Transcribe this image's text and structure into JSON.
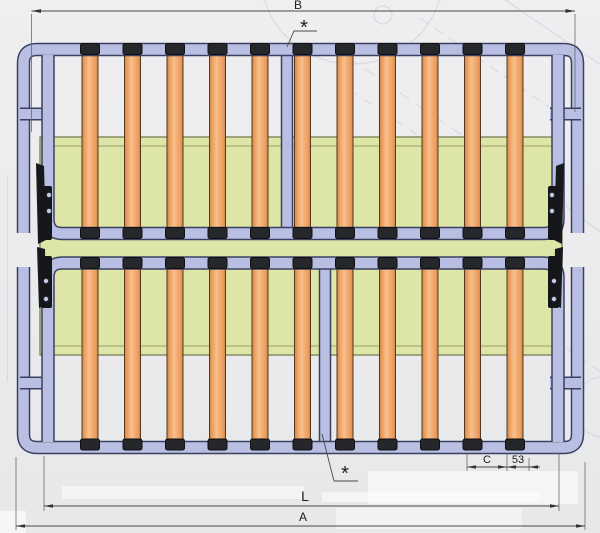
{
  "meta": {
    "subject": "folding slatted bed-base frame, plan view technical drawing"
  },
  "labels": {
    "dim_b": "B",
    "asterisk_top": "*",
    "asterisk_bottom": "*",
    "dim_c": "C",
    "dim_53": "53",
    "dim_l": "L",
    "dim_a": "A"
  },
  "colors": {
    "background": "#ebecee",
    "frame_tube": "#b9bfe3",
    "frame_outline": "#3c4060",
    "slat_wood": "#f3a96f",
    "slat_highlight": "#f8c08d",
    "slat_edge": "#cf8848",
    "support_panel": "#dde5a7",
    "panel_edge": "#70744a",
    "slat_cap": "#25272b",
    "hinge": "#17191d",
    "dimension_line": "#4a4a4a",
    "watermark": "#d6d7da"
  },
  "structure": {
    "halves": 2,
    "slats_per_half": 11,
    "slat_caps_per_half": 22,
    "hinge_plates_per_side": 2,
    "center_rails": 2
  }
}
